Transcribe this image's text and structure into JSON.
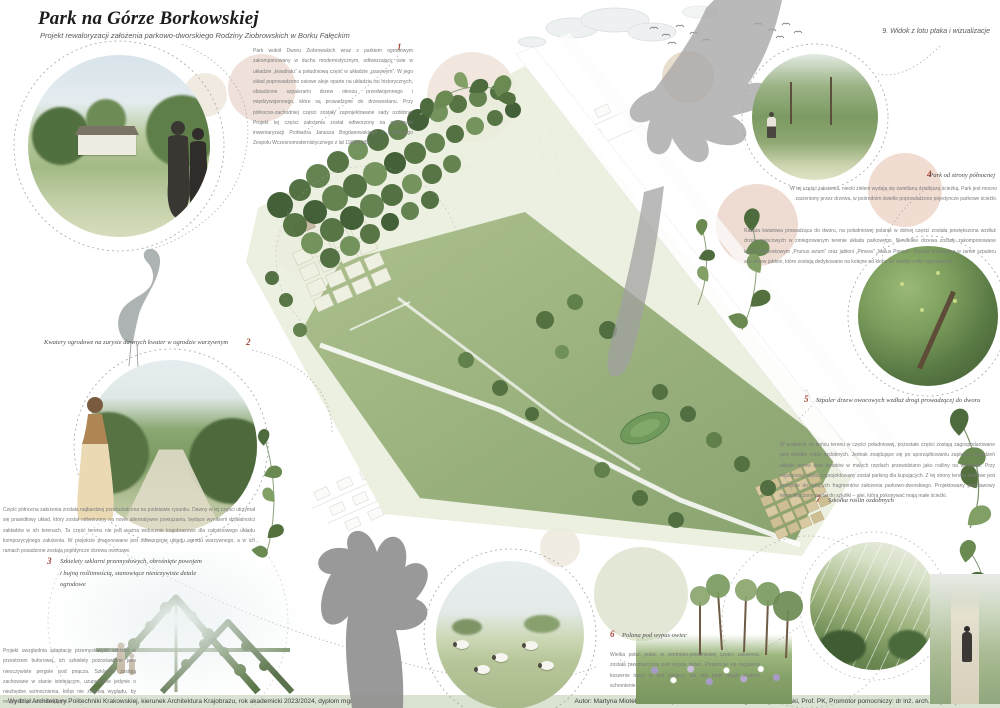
{
  "poster": {
    "title": "Park na Górze Borkowskiej",
    "subtitle": "Projekt rewaloryzacji założenia parkowo-dworskiego Rodziny Ziobrowskich w Borku Fałęckim",
    "sheet_label": "9. Widok z lotu ptaka i wizualizacje"
  },
  "markers": {
    "m1": "1",
    "m2": "2",
    "m3": "3",
    "m4": "4",
    "m5": "5",
    "m6": "6",
    "m7": "7"
  },
  "captions": {
    "c2": "Kwatery ogrodowe na zarysie dawnych kwater w ogrodzie warzywnym",
    "c3": "Szkielety szklarni przemysłowych, obrośnięte powojem i bujną roślinnością, stanowiące nieoczywiste detale ogrodowe",
    "c4": "Park od strony północnej",
    "c5": "Szpaler drzew owocowych wzdłuż drogi prowadzącej do dworu",
    "c6": "Polana pod wypas owiec",
    "c7": "Szkółka roślin ozdobnych"
  },
  "paragraphs": {
    "intro": "Park wokół Dworu Ziobrowskich wraz z parkiem ogrodowym zakomponowany w duchu modernistycznym, odtwarzający osie w układzie „kwadratu” a południową część w układzie „pasowym”. W jego skład poprowadzono osiowe aleje oparte na układzie osi historycznych, obsadzone szpalerami drzew okresu przedwojennego i międzywojennego, które są prowadzone do drzewostanu. Przy północno-zachodniej części zostały zaprojektowane sady ozdobne. Projekt tej części założenia został odtworzony na podstawie inwentaryzacji Profesora Janusza Bogdanowskiego i Parkowego Zespołu Wczesnomodernistycznego z lat 1980/1985.",
    "p4": "W tej części założenia, niecki zieleni wydają się świetlaną dzisiejszą ścieżką. Park jest mocno zacieniony przez drzewa, w pośrednim świetle poprowadzono pojedyncze parkowe ścieżki.",
    "r2": "Rabata kwiatowa prowadząca do dworu, na południowej polanie w dolnej części została powiększona wzdłuż drzew owocowych w zintegrowanym terenie układu parkowego. Niewielkie drzewa zostały zakomponowane kołem arabeskowym „Prunus avium” oraz jabłoni „Pinova” „Malus Pinova”. Została powiązana w ramie szpaleru alei drzew jabłoni, które zostają dedykowane na kolejne od klonu do szkółki roślin ogrodowych.",
    "r5": "W projekcie na końcu terenu w części południowej, pozostałe części zostają zagospodarowane pod szkółkę roślin ozdobnych. Jednak znajdujące się po uporządkowaniu zaplecze nasadzeń układu drzew oraz kwiatów w małych rzędach przewidziano jako rośliny na sprzedaż. Przy najstarszej części zaprojektowany został parking dla kupujących. Z tej strony terenu możliwe jest przejście do leżących fragmentów założenia parkowo-dworskiego. Projektowany podstawowy teren włączony został do szkółki – alei, którą pokonywać mają małe ścieżki.",
    "left": "Część północna założenia została najbardziej przekształcona na podstawie rysunku. Dawny w tej części utrzymał się prawidłowy układ, który został odtworzony na nowe alternatywne powiązania, będące wynikiem działalności zakładów w ich terenach. Ta część terenu nie jest ważna widocznie krajobrazowo dla całościowego układu kompozycyjnego założenia. W projekcie proponowane jest odtworzenie układu ogrodu warzywnego, a w ich ramach posadzone zostają pojedyncze drzewa owocowe.",
    "bottom_left": "Projekt uwzględnia adaptację przemysłowych szklarni w przestrzeni buforowej, ich szkielety pozostawione jako nieoczywiste pergole pod pnącza. Szklarnie zostają zachowane w stanie istniejącym, uzupełnione jedynie o niezbędne wzmocnienia, które nie zmienią wyglądu, by mogły służyć odwiedzającym.",
    "p6": "Wielka połać polan w centralno-południowej części założenia, została przeznaczona pod wypas owiec. Proponuje się regularne koszenie trawy w tym miejscu, tak aby ptaki mogły znaleźć schronienie."
  },
  "footer": {
    "left": "Wydział Architektury Politechniki Krakowskiej, kierunek Architektura Krajobrazu, rok akademicki 2023/2024, dyplom mgr",
    "right": "Autor: Martyna Miotek, Promotor: prof dr hab. inż. arch. Zbigniew Myczkowski, Prof. PK, Promotor pomocniczy: dr inż. arch. kraj. Wojciech Bobek"
  },
  "colors": {
    "accent_red": "#a8473b",
    "footer_bg": "#dae2d2",
    "lawn_green": "#9bb07e",
    "tree_green": "#4e6c3e",
    "pastel_blush": "#ecd9cd",
    "hand_gray": "#a0a0a0"
  }
}
